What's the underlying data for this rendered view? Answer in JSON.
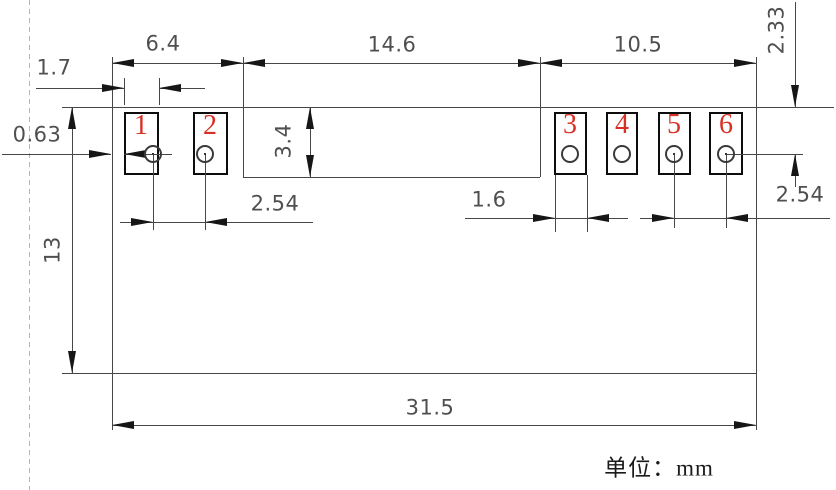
{
  "unit_note": "单位：mm",
  "pads": [
    "1",
    "2",
    "3",
    "4",
    "5",
    "6"
  ],
  "dimensions": {
    "pads12_span": "6.4",
    "middle_span": "14.6",
    "pads36_span": "10.5",
    "pad1_width": "1.7",
    "edge_to_pad1": "0.63",
    "top_to_hole": "2.33",
    "middle_height": "3.4",
    "body_height": "13",
    "pads12_pitch": "2.54",
    "pad3_width": "1.6",
    "pads56_pitch": "2.54",
    "overall_width": "31.5"
  },
  "colors": {
    "line": "#474747",
    "pad_border": "#0d0d0d",
    "arrow": "#161616",
    "dim_text": "#4f4f4f",
    "pad_number": "#d93025",
    "dashed_line": "#b5b5b5"
  }
}
